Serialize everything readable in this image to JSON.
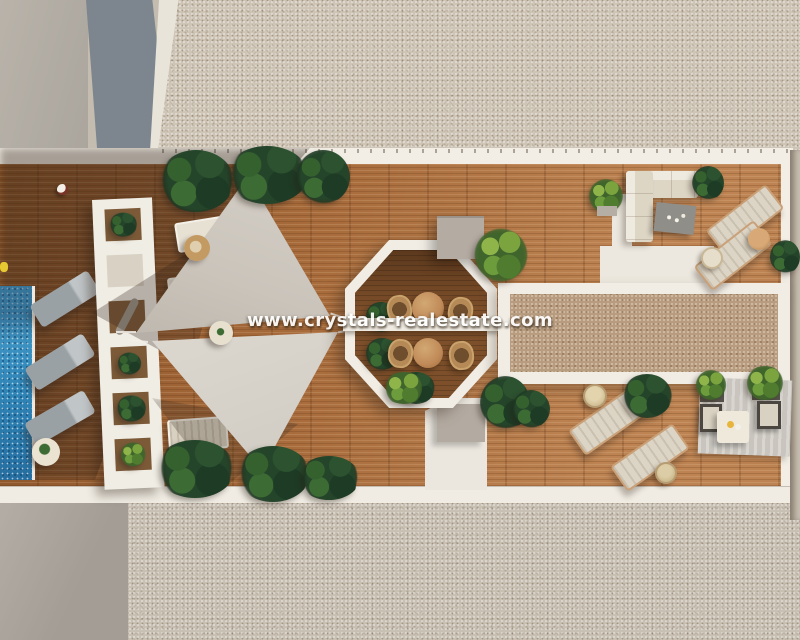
{
  "meta": {
    "type": "aerial-3d-architectural-render",
    "subject": "rooftop terrace with pool deck",
    "watermark_text": "www.crystals-realestate.com"
  },
  "palette": {
    "backdrop": "#c4bcaf",
    "gravel_top": "#cfc5b6",
    "gravel_bottom": "#c8c0b3",
    "gravel_inner": "#b89c80",
    "concrete_warm": "#b6b0a7",
    "concrete_blue": "#7d868e",
    "concrete_bottom": "#aba49c",
    "trim_white": "#f2eee6",
    "wood_light": "#bd8352",
    "wood_mid": "#a86c3c",
    "wood_dark": "#8a5329",
    "wood_octagon": "#7d4f2a",
    "pool_blue": "#2f84b6",
    "pool_blue_light": "#4aa3cf",
    "sail_main": "#cac4bb",
    "sail_light": "#dcd8d0",
    "foliage_dark": "#24452a",
    "foliage_mid": "#35612f",
    "foliage_bright": "#7ba43f",
    "lounger_gray": "#9aa1a5",
    "lounger_cream": "#dcd5c6",
    "table_wood": "#c08a58",
    "wicker": "#b68a57",
    "rug_gray": "#c9c5be",
    "box_gray": "#b3aaa1",
    "watermark_color": "#ffffff"
  },
  "scene_inventory": {
    "areas": [
      "gravel-roof-top",
      "gravel-roof-bottom",
      "concrete-roof-left",
      "wood-deck-terrace",
      "swimming-pool",
      "pergola-walkway",
      "octagon-dining-pergola",
      "gravel-bed-panel"
    ],
    "objects": {
      "shade_sails": 2,
      "sun_loungers": 10,
      "round_dining_tables": 2,
      "wicker_chairs": 4,
      "sofa_seating_groups": 2,
      "side_tables_poufs": 7
    }
  }
}
